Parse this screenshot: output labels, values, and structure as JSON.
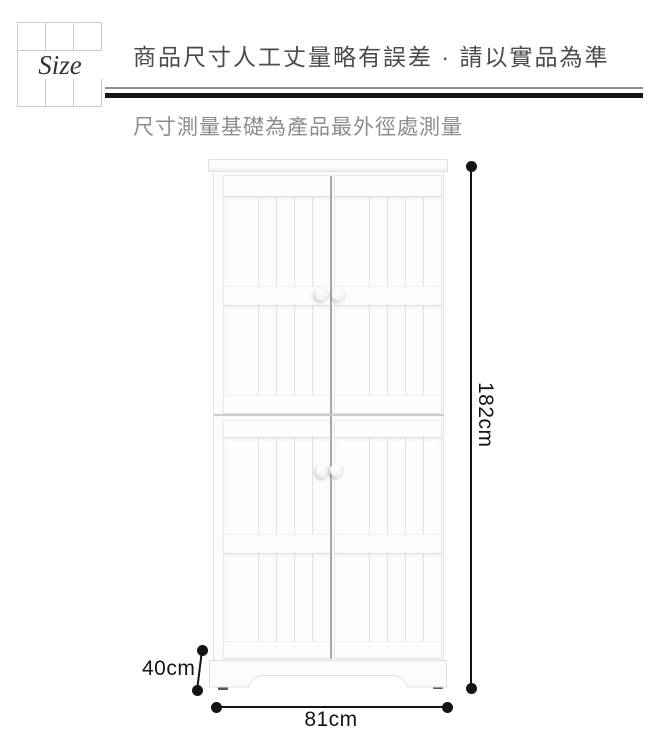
{
  "header": {
    "size_badge": "Size",
    "notice": "商品尺寸人工丈量略有誤差 · 請以實品為準",
    "subtitle": "尺寸測量基礎為產品最外徑處測量"
  },
  "product": {
    "illustration": "white-two-door-four-panel-wardrobe"
  },
  "dimensions": {
    "height": "182cm",
    "width": "81cm",
    "depth": "40cm"
  },
  "colors": {
    "rule_thin": "#8f8f8f",
    "rule_thick": "#141414",
    "notice_text": "#4b4b4b",
    "subtitle_text": "#8c8c8c",
    "grid_line": "#cccccc",
    "dimension_mark": "#141414",
    "cabinet_edge": "#e3e3e3"
  }
}
